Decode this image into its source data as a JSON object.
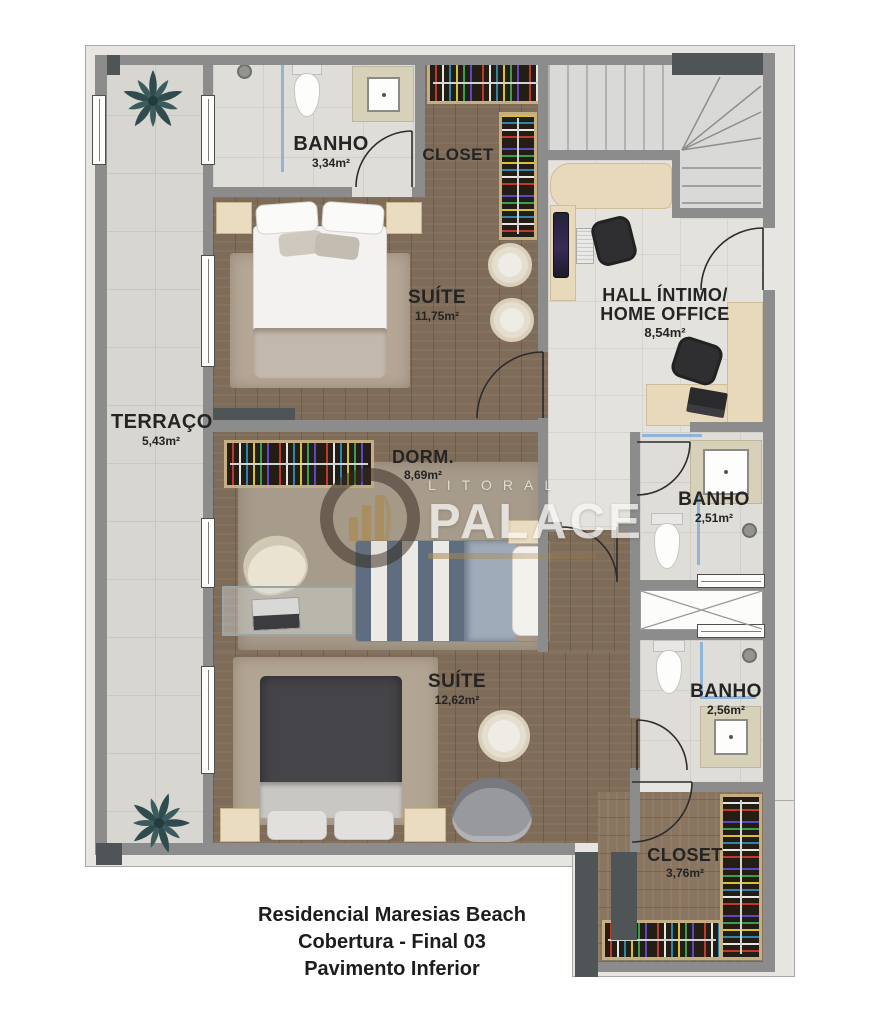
{
  "watermark": {
    "brand_top": "LITORAL",
    "brand_main": "PALACE"
  },
  "footer": {
    "line1": "Residencial Maresias Beach",
    "line2": "Cobertura - Final 03",
    "line3": "Pavimento Inferior"
  },
  "rooms": {
    "terraco": {
      "name": "TERRAÇO",
      "area": "5,43m²"
    },
    "banho_suite_1": {
      "name": "BANHO",
      "area": "3,34m²"
    },
    "closet_suite_1": {
      "name": "CLOSET"
    },
    "suite_1": {
      "name": "SUÍTE",
      "area": "11,75m²"
    },
    "hall_home_office": {
      "name_line_1": "HALL ÍNTIMO/",
      "name_line_2": "HOME OFFICE",
      "area": "8,54m²"
    },
    "dormitorio": {
      "name": "DORM.",
      "area": "8,69m²"
    },
    "banho_social": {
      "name": "BANHO",
      "area": "2,51m²"
    },
    "suite_2": {
      "name": "SUÍTE",
      "area": "12,62m²"
    },
    "banho_suite_2": {
      "name": "BANHO",
      "area": "2,56m²"
    },
    "closet_suite_2": {
      "name": "CLOSET",
      "area": "3,76m²"
    }
  },
  "colors": {
    "wall": "#8C8C8C",
    "wall_dark": "#4F5457",
    "wood_floor": "#7E6B58",
    "tile_floor": "#DCDAD5",
    "shower_glass": "#8FB4D8",
    "wardrobe_trim": "#C6AE83",
    "logo_gold": "#A8894F"
  }
}
